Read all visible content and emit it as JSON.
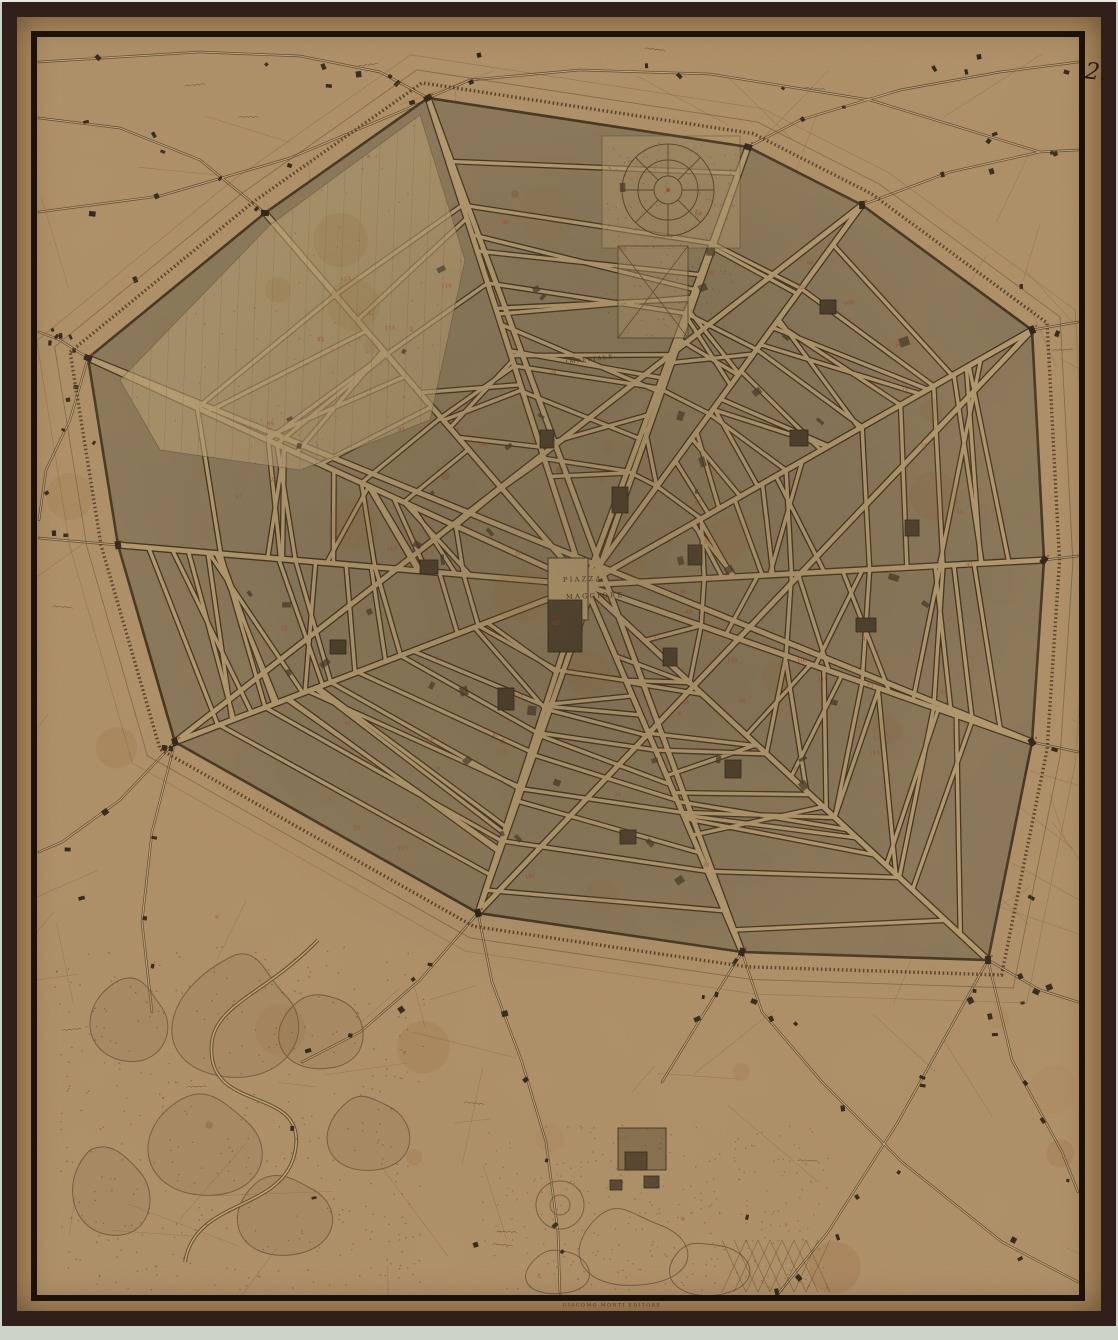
{
  "document": {
    "type_note": "antique engraved city map scan",
    "folio_number": "2.",
    "imprint": "GIACOMO MONTI   EDITORE"
  },
  "map": {
    "labels": {
      "piazza_line1": "PIAZZA",
      "piazza_line2": "MAGGIORE",
      "street_imperiale": "IMPERIALE"
    },
    "colors": {
      "scan_bg": "#ccd3c8",
      "frame_outer": "#31201a",
      "frame_inner": "#1b120b",
      "margin_paper": "#b08e60",
      "paper": "#b2926a",
      "city_block": "#887659",
      "street": "#b79c70",
      "ink": "#33271a",
      "red_marker": "#a63c20"
    }
  }
}
